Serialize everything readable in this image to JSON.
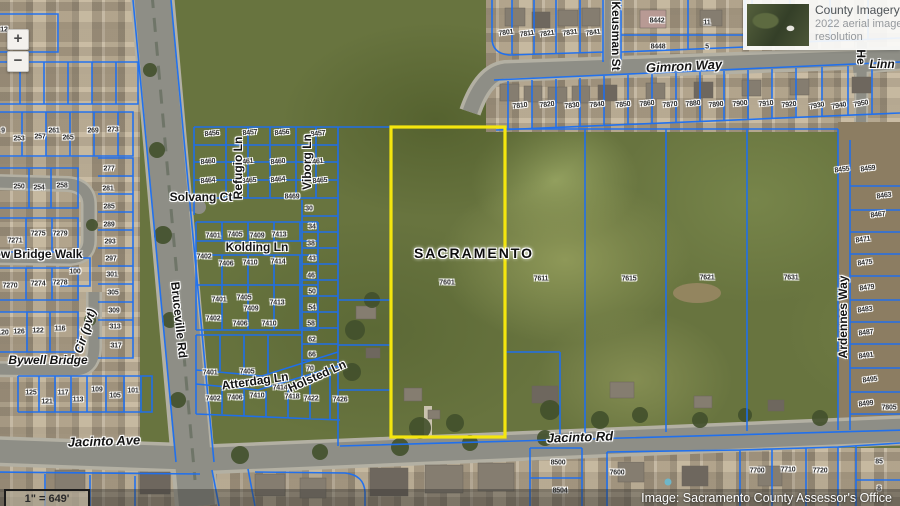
{
  "ui": {
    "zoom_in_label": "+",
    "zoom_out_label": "−",
    "imagery_panel": {
      "title": "County Imagery 2022",
      "subtitle_line1": "2022 aerial imagery at 3",
      "subtitle_line2": "resolution",
      "thumbnail_icon": "aerial-imagery-thumbnail"
    },
    "attribution": "Image: Sacramento County Assessor's Office",
    "scale_text": "1\" = 649'"
  },
  "map": {
    "city_label": "SACRAMENTO",
    "selected_parcel": {
      "number": "7601",
      "outline_color": "#f4e60e"
    },
    "colors": {
      "parcel_line": "#1c6ff2",
      "road": "#8e8e86",
      "field": "#68743f"
    },
    "street_labels": [
      {
        "t": "Solvang Ct",
        "x": 201,
        "y": 197
      },
      {
        "t": "Kolding Ln",
        "x": 257,
        "y": 247
      },
      {
        "t": "Atterdag Ln",
        "x": 255,
        "y": 381,
        "rot": -8
      },
      {
        "t": "Holsted Ln",
        "x": 317,
        "y": 376,
        "rot": -24
      },
      {
        "t": "Refugio Ln",
        "x": 238,
        "y": 168,
        "rot": -90
      },
      {
        "t": "Viborg Ln",
        "x": 307,
        "y": 162,
        "rot": -90
      },
      {
        "t": "Bruceville Rd",
        "x": 179,
        "y": 320,
        "rot": 84
      },
      {
        "t": "Keusman St",
        "x": 616,
        "y": 36,
        "rot": 90
      },
      {
        "t": "Gimron Way",
        "x": 684,
        "y": 66,
        "rot": -3,
        "italic": true,
        "size": 13
      },
      {
        "t": "Jacinto Ave",
        "x": 104,
        "y": 441,
        "rot": -2,
        "italic": true,
        "size": 13
      },
      {
        "t": "Jacinto Rd",
        "x": 580,
        "y": 437,
        "rot": -2,
        "italic": true,
        "size": 13
      },
      {
        "t": "Ardennes Way",
        "x": 843,
        "y": 317,
        "rot": -90
      },
      {
        "t": "Bywell Bridge",
        "x": 48,
        "y": 360,
        "italic": true
      },
      {
        "t": "Cir (pvt)",
        "x": 85,
        "y": 331,
        "rot": -72,
        "italic": true
      },
      {
        "t": "ow Bridge Walk",
        "x": 38,
        "y": 254
      },
      {
        "t": "Linn",
        "x": 882,
        "y": 64,
        "italic": true
      },
      {
        "t": "He",
        "x": 861,
        "y": 57,
        "rot": 90
      }
    ],
    "parcel_labels": [
      {
        "t": "12",
        "x": 4,
        "y": 30
      },
      {
        "t": "9",
        "x": 3,
        "y": 131
      },
      {
        "t": "253",
        "x": 19,
        "y": 139
      },
      {
        "t": "257",
        "x": 40,
        "y": 137
      },
      {
        "t": "261",
        "x": 54,
        "y": 131
      },
      {
        "t": "265",
        "x": 68,
        "y": 138
      },
      {
        "t": "269",
        "x": 93,
        "y": 131
      },
      {
        "t": "273",
        "x": 113,
        "y": 130
      },
      {
        "t": "250",
        "x": 19,
        "y": 187
      },
      {
        "t": "254",
        "x": 39,
        "y": 188
      },
      {
        "t": "258",
        "x": 62,
        "y": 186
      },
      {
        "t": "277",
        "x": 109,
        "y": 169
      },
      {
        "t": "281",
        "x": 108,
        "y": 189
      },
      {
        "t": "285",
        "x": 109,
        "y": 207
      },
      {
        "t": "289",
        "x": 109,
        "y": 225
      },
      {
        "t": "293",
        "x": 110,
        "y": 242
      },
      {
        "t": "297",
        "x": 111,
        "y": 259
      },
      {
        "t": "301",
        "x": 112,
        "y": 275
      },
      {
        "t": "305",
        "x": 113,
        "y": 293
      },
      {
        "t": "309",
        "x": 114,
        "y": 311
      },
      {
        "t": "313",
        "x": 115,
        "y": 327
      },
      {
        "t": "317",
        "x": 116,
        "y": 346
      },
      {
        "t": "7271",
        "x": 15,
        "y": 241
      },
      {
        "t": "7275",
        "x": 38,
        "y": 234
      },
      {
        "t": "7279",
        "x": 60,
        "y": 234
      },
      {
        "t": "100",
        "x": 75,
        "y": 272
      },
      {
        "t": "7270",
        "x": 10,
        "y": 286
      },
      {
        "t": "7274",
        "x": 38,
        "y": 284
      },
      {
        "t": "7278",
        "x": 60,
        "y": 283
      },
      {
        "t": "120",
        "x": 3,
        "y": 333
      },
      {
        "t": "126",
        "x": 19,
        "y": 332
      },
      {
        "t": "122",
        "x": 38,
        "y": 331
      },
      {
        "t": "116",
        "x": 60,
        "y": 329
      },
      {
        "t": "125",
        "x": 31,
        "y": 393
      },
      {
        "t": "121",
        "x": 47,
        "y": 402
      },
      {
        "t": "117",
        "x": 63,
        "y": 393
      },
      {
        "t": "113",
        "x": 78,
        "y": 400
      },
      {
        "t": "109",
        "x": 97,
        "y": 390
      },
      {
        "t": "105",
        "x": 115,
        "y": 396
      },
      {
        "t": "101",
        "x": 133,
        "y": 391
      },
      {
        "t": "8456",
        "x": 212,
        "y": 134,
        "rot": -5
      },
      {
        "t": "8457",
        "x": 250,
        "y": 133,
        "rot": -5
      },
      {
        "t": "8456",
        "x": 282,
        "y": 133,
        "rot": -5
      },
      {
        "t": "8457",
        "x": 318,
        "y": 134,
        "rot": -5
      },
      {
        "t": "8460",
        "x": 208,
        "y": 162,
        "rot": -5
      },
      {
        "t": "8461",
        "x": 246,
        "y": 162,
        "rot": -5
      },
      {
        "t": "8460",
        "x": 278,
        "y": 162,
        "rot": -5
      },
      {
        "t": "8461",
        "x": 316,
        "y": 162,
        "rot": -5
      },
      {
        "t": "8464",
        "x": 208,
        "y": 181,
        "rot": -5
      },
      {
        "t": "8465",
        "x": 249,
        "y": 181,
        "rot": -5
      },
      {
        "t": "8464",
        "x": 278,
        "y": 180,
        "rot": -5
      },
      {
        "t": "8465",
        "x": 320,
        "y": 181,
        "rot": -5
      },
      {
        "t": "8469",
        "x": 292,
        "y": 197
      },
      {
        "t": "30",
        "x": 309,
        "y": 209
      },
      {
        "t": "34",
        "x": 312,
        "y": 227
      },
      {
        "t": "38",
        "x": 311,
        "y": 244
      },
      {
        "t": "43",
        "x": 312,
        "y": 259
      },
      {
        "t": "46",
        "x": 311,
        "y": 276
      },
      {
        "t": "50",
        "x": 312,
        "y": 292
      },
      {
        "t": "54",
        "x": 312,
        "y": 308
      },
      {
        "t": "58",
        "x": 311,
        "y": 324
      },
      {
        "t": "62",
        "x": 312,
        "y": 340
      },
      {
        "t": "66",
        "x": 312,
        "y": 355
      },
      {
        "t": "70",
        "x": 310,
        "y": 369
      },
      {
        "t": "7401",
        "x": 213,
        "y": 236
      },
      {
        "t": "7405",
        "x": 235,
        "y": 235
      },
      {
        "t": "7409",
        "x": 257,
        "y": 236
      },
      {
        "t": "7413",
        "x": 279,
        "y": 235
      },
      {
        "t": "7402",
        "x": 204,
        "y": 257
      },
      {
        "t": "7406",
        "x": 226,
        "y": 264
      },
      {
        "t": "7410",
        "x": 250,
        "y": 263
      },
      {
        "t": "7414",
        "x": 278,
        "y": 262
      },
      {
        "t": "7401",
        "x": 219,
        "y": 300
      },
      {
        "t": "7405",
        "x": 244,
        "y": 298
      },
      {
        "t": "7409",
        "x": 251,
        "y": 309
      },
      {
        "t": "7413",
        "x": 277,
        "y": 303
      },
      {
        "t": "7402",
        "x": 213,
        "y": 319
      },
      {
        "t": "7406",
        "x": 240,
        "y": 324
      },
      {
        "t": "7410",
        "x": 269,
        "y": 324
      },
      {
        "t": "7401",
        "x": 210,
        "y": 373
      },
      {
        "t": "7405",
        "x": 247,
        "y": 372
      },
      {
        "t": "7414",
        "x": 280,
        "y": 388
      },
      {
        "t": "7402",
        "x": 213,
        "y": 399
      },
      {
        "t": "7406",
        "x": 235,
        "y": 398
      },
      {
        "t": "7410",
        "x": 257,
        "y": 396
      },
      {
        "t": "7418",
        "x": 292,
        "y": 397
      },
      {
        "t": "7422",
        "x": 311,
        "y": 399
      },
      {
        "t": "7426",
        "x": 340,
        "y": 400
      },
      {
        "t": "7801",
        "x": 506,
        "y": 33,
        "rot": -8
      },
      {
        "t": "7811",
        "x": 527,
        "y": 34,
        "rot": -8
      },
      {
        "t": "7821",
        "x": 547,
        "y": 34,
        "rot": -8
      },
      {
        "t": "7831",
        "x": 570,
        "y": 33,
        "rot": -8
      },
      {
        "t": "7841",
        "x": 593,
        "y": 33,
        "rot": -8
      },
      {
        "t": "8442",
        "x": 657,
        "y": 21
      },
      {
        "t": "8448",
        "x": 658,
        "y": 47
      },
      {
        "t": "11",
        "x": 707,
        "y": 23
      },
      {
        "t": "5",
        "x": 707,
        "y": 47
      },
      {
        "t": "7810",
        "x": 520,
        "y": 106,
        "rot": -6
      },
      {
        "t": "7820",
        "x": 547,
        "y": 105,
        "rot": -6
      },
      {
        "t": "7830",
        "x": 572,
        "y": 106,
        "rot": -6
      },
      {
        "t": "7840",
        "x": 597,
        "y": 105,
        "rot": -6
      },
      {
        "t": "7850",
        "x": 623,
        "y": 105,
        "rot": -6
      },
      {
        "t": "7860",
        "x": 647,
        "y": 104,
        "rot": -6
      },
      {
        "t": "7870",
        "x": 670,
        "y": 105,
        "rot": -6
      },
      {
        "t": "7880",
        "x": 693,
        "y": 104,
        "rot": -6
      },
      {
        "t": "7890",
        "x": 716,
        "y": 105,
        "rot": -6
      },
      {
        "t": "7900",
        "x": 740,
        "y": 104,
        "rot": -6
      },
      {
        "t": "7910",
        "x": 766,
        "y": 104,
        "rot": -6
      },
      {
        "t": "7920",
        "x": 789,
        "y": 105,
        "rot": -6
      },
      {
        "t": "7930",
        "x": 817,
        "y": 106,
        "rot": -10
      },
      {
        "t": "7940",
        "x": 839,
        "y": 106,
        "rot": -10
      },
      {
        "t": "7950",
        "x": 861,
        "y": 104,
        "rot": -10
      },
      {
        "t": "8455",
        "x": 842,
        "y": 170,
        "rot": -8
      },
      {
        "t": "8459",
        "x": 868,
        "y": 169,
        "rot": -8
      },
      {
        "t": "8463",
        "x": 884,
        "y": 196,
        "rot": -8
      },
      {
        "t": "8467",
        "x": 878,
        "y": 215,
        "rot": -8
      },
      {
        "t": "8471",
        "x": 863,
        "y": 240,
        "rot": -8
      },
      {
        "t": "8475",
        "x": 865,
        "y": 263,
        "rot": -8
      },
      {
        "t": "8479",
        "x": 867,
        "y": 288,
        "rot": -8
      },
      {
        "t": "8483",
        "x": 865,
        "y": 310,
        "rot": -8
      },
      {
        "t": "8487",
        "x": 866,
        "y": 333,
        "rot": -8
      },
      {
        "t": "8491",
        "x": 866,
        "y": 356,
        "rot": -8
      },
      {
        "t": "8495",
        "x": 870,
        "y": 380,
        "rot": -8
      },
      {
        "t": "8499",
        "x": 866,
        "y": 404,
        "rot": -8
      },
      {
        "t": "7805",
        "x": 889,
        "y": 408
      },
      {
        "t": "7611",
        "x": 541,
        "y": 279
      },
      {
        "t": "7615",
        "x": 629,
        "y": 279
      },
      {
        "t": "7621",
        "x": 707,
        "y": 278
      },
      {
        "t": "7631",
        "x": 791,
        "y": 278
      },
      {
        "t": "8500",
        "x": 558,
        "y": 463
      },
      {
        "t": "8504",
        "x": 560,
        "y": 491
      },
      {
        "t": "7600",
        "x": 617,
        "y": 473
      },
      {
        "t": "7700",
        "x": 757,
        "y": 471
      },
      {
        "t": "7710",
        "x": 788,
        "y": 470
      },
      {
        "t": "7720",
        "x": 820,
        "y": 471
      },
      {
        "t": "85",
        "x": 879,
        "y": 462
      },
      {
        "t": "8",
        "x": 879,
        "y": 489
      }
    ]
  }
}
